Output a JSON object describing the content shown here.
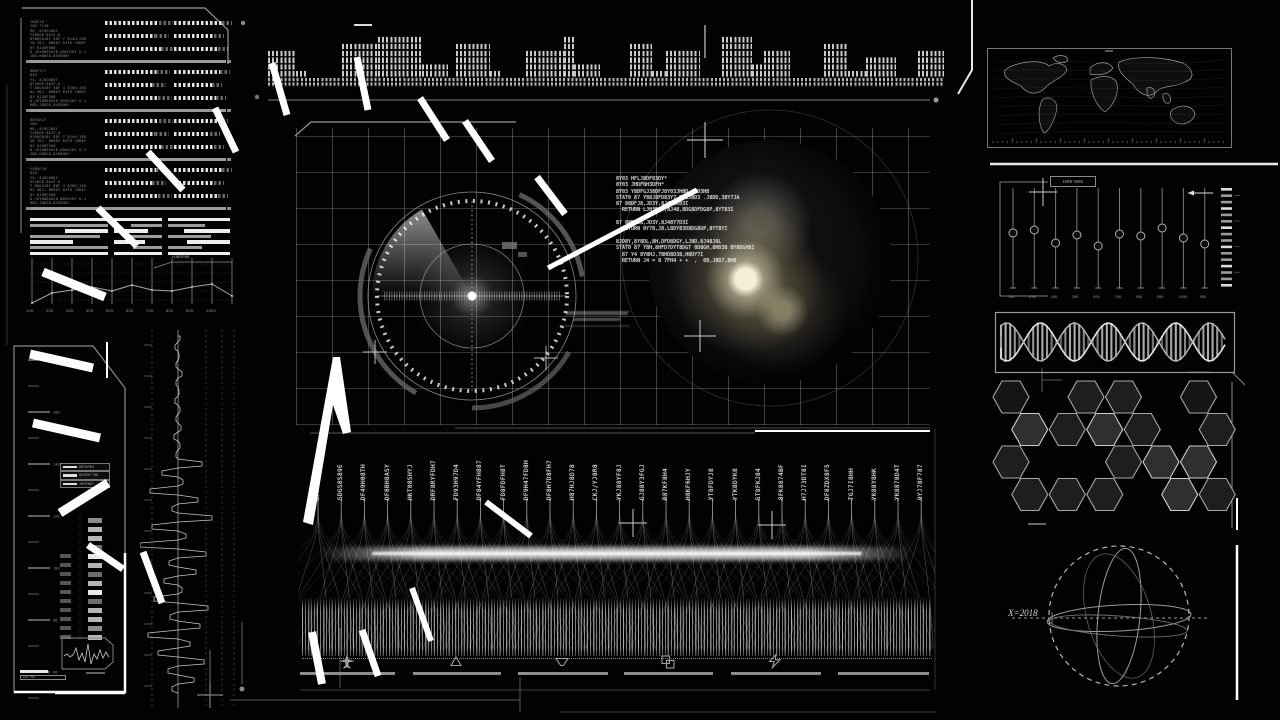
{
  "colors": {
    "bg": "#020202",
    "line_gray": "#8a8a8a",
    "line_dim": "#444444",
    "bright": "#ffffff",
    "globe_light": "#f2e8c0",
    "grid": "#d2d2d2",
    "hex_stroke": "#a8a8a8"
  },
  "tl_panel": {
    "blocks": [
      {
        "lines": [
          "Y8DFJ8",
          "J8D 7Y48",
          "HD- 8YDGJ8DY",
          "YJ8DG8 8DJF-8",
          "8Y8DGHJ8Y 8DF 7 8J4H-J8D",
          "J8 7DJ- 8H8DY 8JFD 78D8Y",
          "8Y 8J4DFGH8",
          "8 J8YD8DGHJ8,8DGHJ8Y 8-J",
          "J8D,H8DG8,8YD8H8Y"
        ]
      },
      {
        "lines": [
          "H8DFY7J",
          "8JD",
          "Y4- 8JDGH8DY",
          "8YJDG8 8DJF-8",
          "7 8DGHJ8Y 8DF 4 8J8H-J8D",
          "8J 4DJ- 8H8DY 8JFD 78D8Y",
          "8Y 8J4DFGH8",
          "8 J8YD8DGHJ8,8DGHJ8Y 8-J",
          "H8D,J8DG8,8YD8H8Y"
        ]
      },
      {
        "lines": [
          "8DFGHJ7",
          "J8D",
          "HD- 8YDGJ8DY",
          "YJ8DG8 8DJF-8",
          "8Y8DGHJ8Y 8DF 7 8J4H-J8D",
          "J8 7DJ- 8H8DY 8JFD 78D8Y",
          "8Y 8J4DFGH8",
          "8 J8YD8DGHJ8,8DGHJ8Y 8-J",
          "J8D,H8DG8,8YD8H8Y"
        ]
      },
      {
        "lines": [
          "Y48DFJ8",
          "8JD",
          "Y4- 8JDGH8DY",
          "8YJDG8 8DJF-8",
          "7 8DGHJ8Y 8DF 4 8J8H-J8D",
          "8J 4DJ- 8H8DY 8JFD 78D8Y",
          "8Y 8J4DFGH8",
          "8 J8YD8DGHJ8,8DGHJ8Y 8-J",
          "H8D,J8DG8,8YD8H8Y"
        ]
      }
    ],
    "dot_groups": [
      [
        54,
        48
      ],
      [
        50,
        40
      ],
      [
        56,
        44
      ]
    ]
  },
  "eq_strip": {
    "segments": [
      [
        28,
        4
      ],
      [
        12,
        1
      ],
      [
        34,
        0
      ],
      [
        36,
        5
      ],
      [
        44,
        6
      ],
      [
        26,
        2
      ],
      [
        8,
        0
      ],
      [
        34,
        5
      ],
      [
        12,
        1
      ],
      [
        24,
        0
      ],
      [
        38,
        4
      ],
      [
        10,
        6
      ],
      [
        26,
        2
      ],
      [
        30,
        0
      ],
      [
        22,
        5
      ],
      [
        14,
        1
      ],
      [
        34,
        4
      ],
      [
        22,
        0
      ],
      [
        30,
        6
      ],
      [
        12,
        2
      ],
      [
        26,
        4
      ],
      [
        34,
        0
      ],
      [
        24,
        5
      ],
      [
        18,
        1
      ],
      [
        30,
        3
      ],
      [
        22,
        0
      ],
      [
        26,
        4
      ]
    ]
  },
  "bars_block": {
    "groups": [
      {
        "x": 30,
        "w": 78,
        "rows": [
          [
            0,
            1,
            1
          ],
          [
            0,
            1,
            0
          ],
          [
            0.45,
            0.55,
            1
          ],
          [
            0,
            0.9,
            0
          ],
          [
            0,
            0.55,
            1
          ],
          [
            0,
            1,
            0
          ],
          [
            0,
            1,
            1
          ]
        ]
      },
      {
        "x": 114,
        "w": 48,
        "rows": [
          [
            0,
            1,
            1
          ],
          [
            0.35,
            0.65,
            0
          ],
          [
            0,
            0.7,
            1
          ],
          [
            0.3,
            0.7,
            0
          ],
          [
            0,
            0.65,
            1
          ],
          [
            0.4,
            0.6,
            0
          ],
          [
            0,
            1,
            1
          ]
        ]
      },
      {
        "x": 168,
        "w": 62,
        "rows": [
          [
            0,
            1,
            1
          ],
          [
            0,
            0.6,
            0
          ],
          [
            0.25,
            0.75,
            1
          ],
          [
            0,
            0.7,
            0
          ],
          [
            0.3,
            0.7,
            1
          ],
          [
            0,
            0.55,
            0
          ],
          [
            0,
            1,
            1
          ]
        ]
      }
    ]
  },
  "mini_chart": {
    "x_labels": [
      "100",
      "200",
      "300",
      "400",
      "500",
      "600",
      "700",
      "800",
      "900",
      "1000"
    ],
    "points": [
      303,
      293,
      290,
      287,
      291,
      285,
      290,
      291,
      287,
      284,
      296
    ],
    "callout": "HJ8DF88"
  },
  "left_panel": {
    "ruler_labels": [
      "188",
      "168",
      "148",
      "128",
      "108",
      "88",
      "68"
    ],
    "box_labels": [
      "8B7DF8H",
      "8DJF8Y 788",
      "JHDF88Y"
    ],
    "footer_label": "8DF7H8"
  },
  "radar": {
    "streaks": 3
  },
  "center": {
    "code_lines": [
      "8Y03 HFLJ8DF03DY*",
      "8Y03 JHDF8H3DFH*",
      "8Y03 Y8DFGJ38DFJ8Y03JH8D,J8D3H8",
      "STAT0 87 Y88J8FD83Y7-8JLJ8D3 .J8DD,38Y7JA",
      "87 08DFJ8,JD3Y,8J48JK03I",
      "  RETURN LJ03D8Y,8J48,8DG8DFDG8P,8YT83I",
      "",
      "87 08DFJ8,JD3Y,8J48Y7D3I",
      "  RETURN 8Y78,J8,L8DY83D8DG8UP,8YT8YI",
      "",
      "8JD8Y,8Y8DL,8H,DFD8DGY,LJ8D,8J48J8L",
      "STAT0 87 Y8H,8HFD7DYT8DGT 0D8GH,8HD38 8Y8DGH8I",
      "  87 Y4 8Y8HJ,78HD8D38,H8DY7I",
      "  RETURN J4 = 8 7FH4 + +  ,  08,J8D7,8H8"
    ]
  },
  "table": {
    "codes": [
      "GFH4DF8Y9",
      "SDGS8S89E",
      "DF49H08TH",
      "DF8BH8ASY",
      "HKT08SHYJ",
      "DRF8RYFDH7",
      "FD93H97D4",
      "DF84YFH887",
      "FD8FDFH8T",
      "DF9H47FD8H",
      "DF8H7D8FH7",
      "H87HJ8D78",
      "CKJ/YJ8R8",
      "YKJ88YF8J",
      "GJ88Y3FGJ",
      "B87KF8H4",
      "H8KF6HJY",
      "YT8FDYJ8",
      "YTK8DYK8",
      "ST8FKJ84",
      "8FK8874BF",
      "H7J73DT8I",
      "DF8ZDX8F5",
      "TGJ7I8HH",
      "YK88Y8HK",
      "YK8878D4T",
      "9YJ78F787"
    ],
    "icons": [
      {
        "name": "airplane-icon"
      },
      {
        "name": "triangle-up-icon"
      },
      {
        "name": "triangle-down-icon"
      },
      {
        "name": "overlap-squares-icon"
      },
      {
        "name": "lightning-icon"
      }
    ]
  },
  "sliders": {
    "header": "H88-988",
    "values": [
      0.45,
      0.42,
      0.55,
      0.47,
      0.58,
      0.46,
      0.48,
      0.4,
      0.5,
      0.56
    ],
    "bottom_labels": [
      "788",
      "898",
      "488",
      "388",
      "898",
      "788",
      "988",
      "888",
      "1888",
      "988"
    ]
  },
  "sphere": {
    "x_label": "X=2018"
  },
  "hexes": {
    "cells": [
      {
        "r": 0,
        "c": 0,
        "f": 0
      },
      {
        "r": 0,
        "c": 2,
        "f": 1
      },
      {
        "r": 0,
        "c": 3,
        "f": 1
      },
      {
        "r": 0,
        "c": 5,
        "f": 0
      },
      {
        "r": 1,
        "c": 0,
        "f": 2
      },
      {
        "r": 1,
        "c": 1,
        "f": 1
      },
      {
        "r": 1,
        "c": 2,
        "f": 2
      },
      {
        "r": 1,
        "c": 3,
        "f": 1
      },
      {
        "r": 1,
        "c": 5,
        "f": 1
      },
      {
        "r": 2,
        "c": 0,
        "f": 1
      },
      {
        "r": 2,
        "c": 3,
        "f": 1
      },
      {
        "r": 2,
        "c": 4,
        "f": 2
      },
      {
        "r": 2,
        "c": 5,
        "f": 2
      },
      {
        "r": 3,
        "c": 0,
        "f": 1
      },
      {
        "r": 3,
        "c": 1,
        "f": 1
      },
      {
        "r": 3,
        "c": 2,
        "f": 1
      },
      {
        "r": 3,
        "c": 4,
        "f": 2
      },
      {
        "r": 3,
        "c": 5,
        "f": 1
      }
    ],
    "fills": [
      "#151515",
      "#1e1e1e",
      "#2f2f2f"
    ]
  },
  "trace": {
    "amps": [
      2,
      -3,
      1,
      -2,
      4,
      -2,
      1,
      -3,
      2,
      -2,
      3,
      -4,
      2,
      -2,
      24,
      -16,
      5,
      -28,
      20,
      -6,
      34,
      -26,
      8,
      -38,
      28,
      -9,
      18,
      -14,
      4,
      -24,
      30,
      -8,
      22,
      -30,
      12,
      -20,
      26,
      -10,
      16,
      -6
    ]
  }
}
